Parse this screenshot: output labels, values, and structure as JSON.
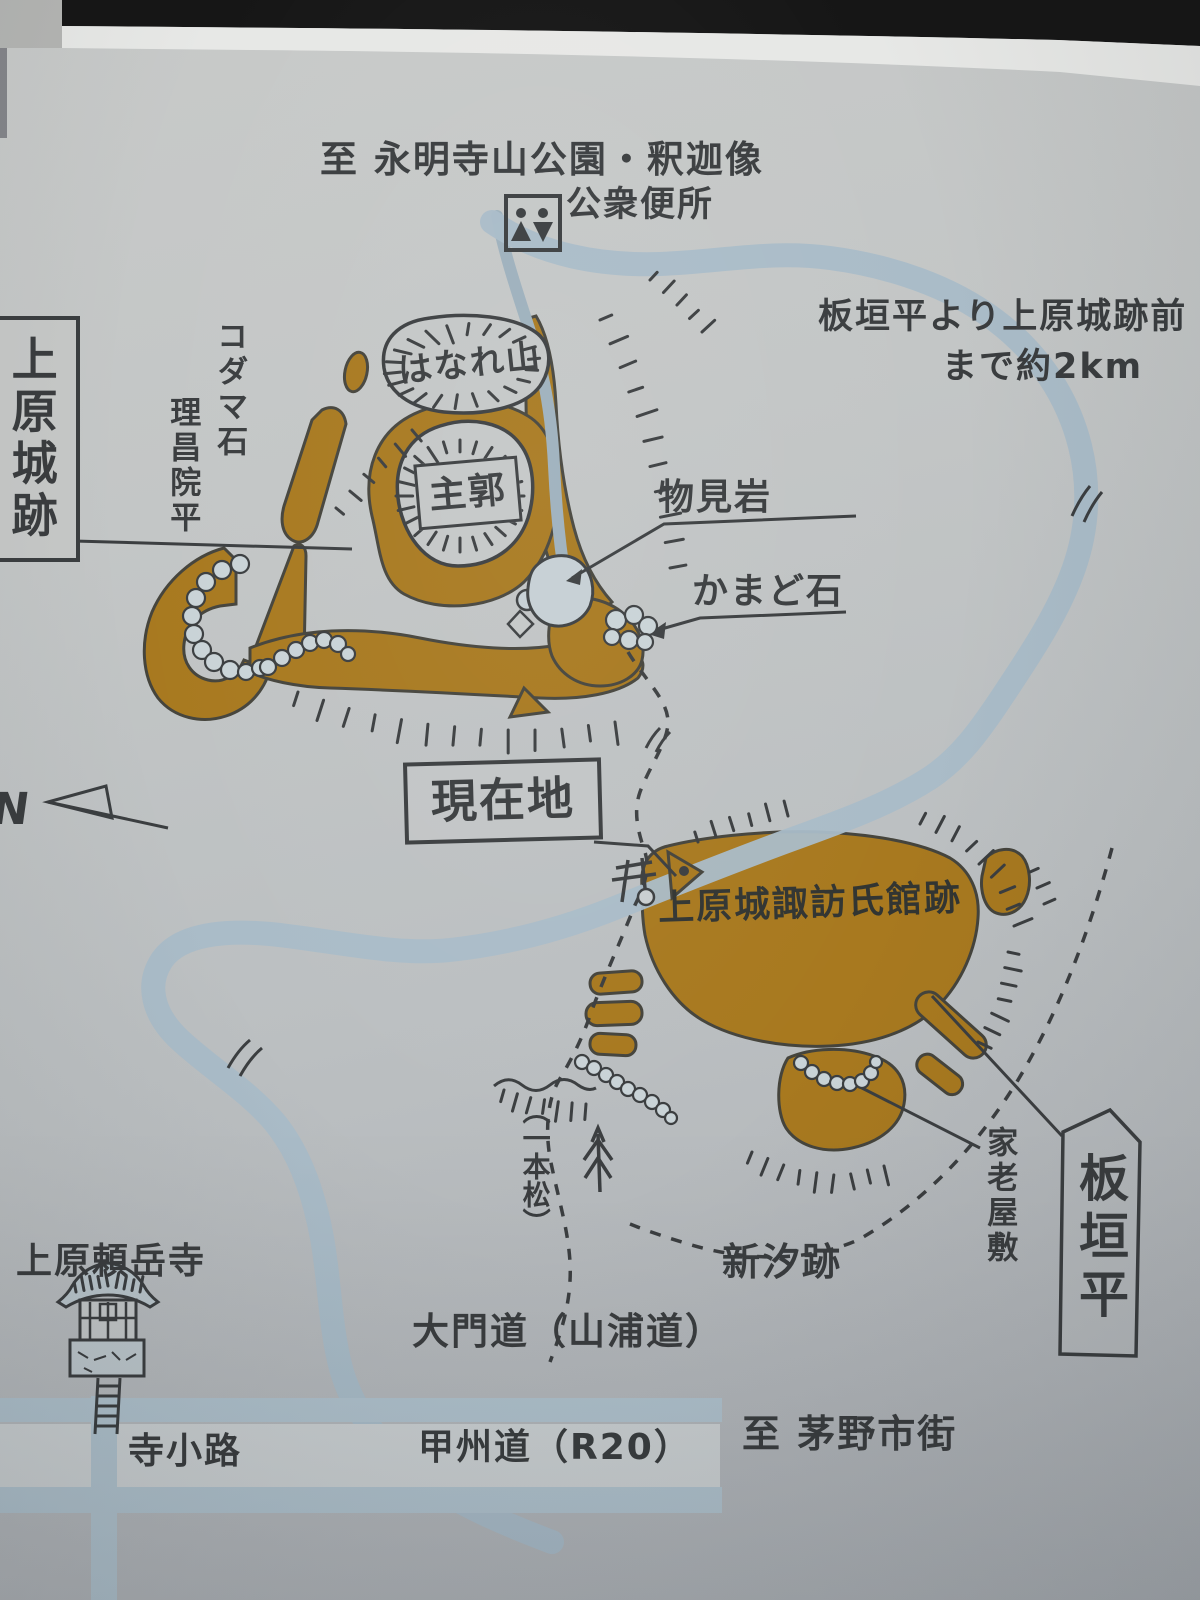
{
  "sign": {
    "top_destination": "至 永明寺山公園・釈迦像",
    "public_toilet": "公衆便所",
    "distance_note_line1": "板垣平より上原城跡前",
    "distance_note_line2": "まで約2km",
    "castle_title": "上原城跡",
    "kodama_stone": "コダマ石",
    "rishoin_daira": "理昌院平",
    "hanare_yama": "はなれ山",
    "main_bailey": "主郭",
    "monomi_iwa": "物見岩",
    "kamado_ishi": "かまど石",
    "you_are_here": "現在地",
    "mansion_site": "上原城諏訪氏館跡",
    "karo_yashiki": "家老屋敷",
    "itagaki_daira": "板垣平",
    "shinshio_ato": "新汐跡",
    "ippon_matsu": "（一本松）",
    "raigakuji": "上原頼岳寺",
    "daimon_road": "大門道（山浦道）",
    "tera_koji": "寺小路",
    "koshu_road": "甲州道（R20）",
    "to_chino": "至 茅野市街",
    "north_letter": "N"
  },
  "icons": {
    "toilet": "toilet-pictogram",
    "temple": "buddhist-temple-icon",
    "pine": "lone-pine-tree-icon",
    "north": "north-arrow",
    "gate_mark": "temple-gate-mark"
  },
  "colors": {
    "earthwork_brown": "#a8791f",
    "water_blue": "#a9bcc8",
    "road_blue": "#b0c2cd",
    "ink": "#3b3e40",
    "stone_gray": "#c9d3d7",
    "sign_face": "#c3c6c7"
  }
}
